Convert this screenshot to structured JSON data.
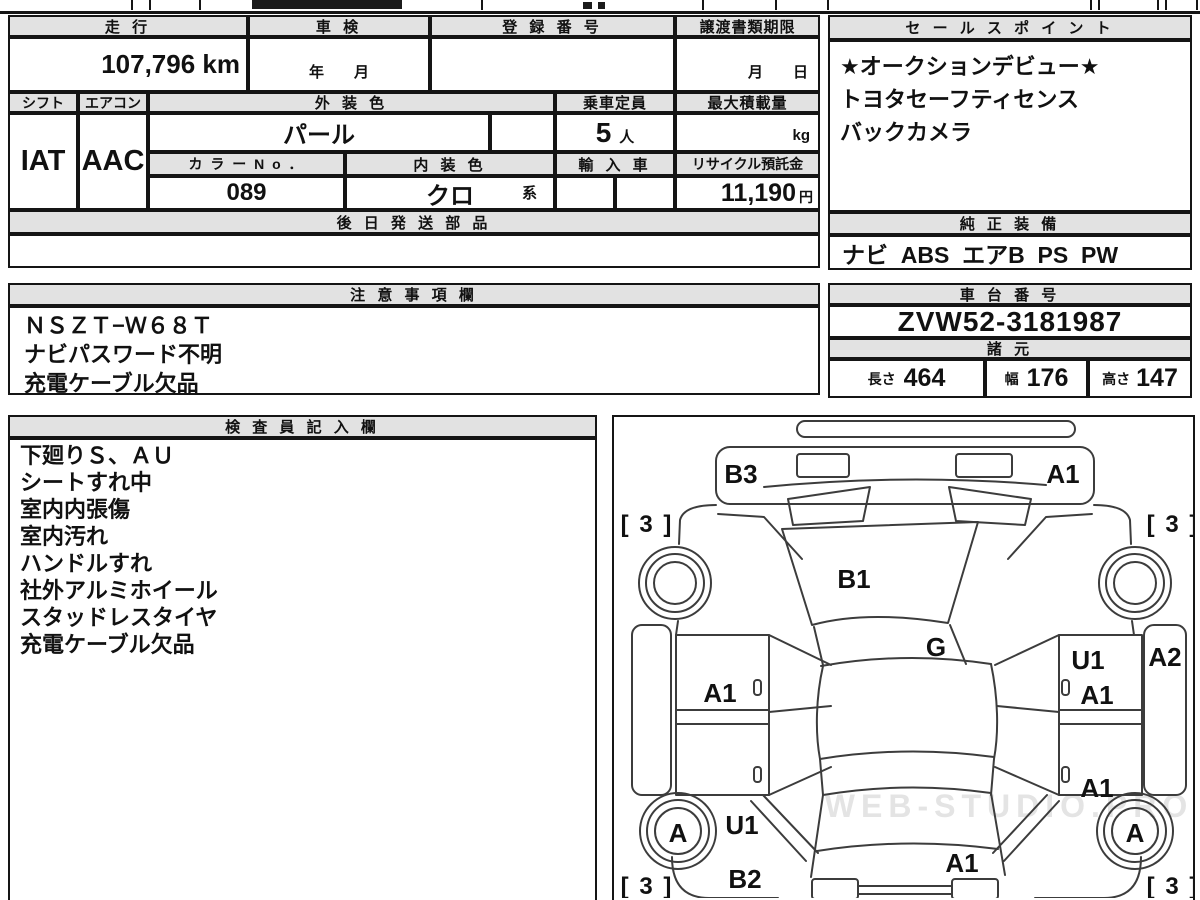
{
  "table": {
    "headers": {
      "mileage": "走 行",
      "shaken": "車 検",
      "registration_no": "登 録 番 号",
      "transfer_deadline": "譲渡書類期限",
      "shift": "シフト",
      "aircon": "エアコン",
      "exterior_color": "外 装 色",
      "capacity": "乗車定員",
      "max_load": "最大積載量",
      "color_no": "カ ラ ー N o ．",
      "interior_color": "内 装 色",
      "import_car": "輸 入 車",
      "recycle_deposit": "リサイクル預託金",
      "later_shipped_parts": "後 日 発 送 部 品"
    },
    "values": {
      "mileage": "107,796 km",
      "shaken_date": "年　　月",
      "registration_no": "",
      "transfer_deadline": "月　　日",
      "shift": "IAT",
      "aircon": "AAC",
      "exterior_color": "パール",
      "capacity_value": "5",
      "capacity_unit": "人",
      "max_load_unit": "kg",
      "color_no": "089",
      "interior_color": "クロ",
      "interior_color_suffix": "系",
      "recycle_deposit": "11,190",
      "recycle_deposit_unit": "円"
    }
  },
  "sales_point": {
    "title": "セ ー ル ス ポ イ ン ト",
    "line1": "★オークションデビュー★",
    "line2": "トヨタセーフティセンス",
    "line3": "バックカメラ"
  },
  "equipment": {
    "title": "純 正 装 備",
    "value": "ナビ  ABS  エアB  PS  PW"
  },
  "notes": {
    "title": "注 意 事 項 欄",
    "line1": "ＮＳＺＴ−Ｗ６８Ｔ",
    "line2": "ナビパスワード不明",
    "line3": "充電ケーブル欠品"
  },
  "chassis": {
    "title": "車 台 番 号",
    "value": "ZVW52-3181987"
  },
  "specs": {
    "title": "諸 元",
    "length_label": "長さ",
    "length_value": "464",
    "width_label": "幅",
    "width_value": "176",
    "height_label": "高さ",
    "height_value": "147"
  },
  "inspector": {
    "title": "検 査 員 記 入 欄",
    "line1": "下廻りＳ、ＡＵ",
    "line2": "シートすれ中",
    "line3": "室内内張傷",
    "line4": "室内汚れ",
    "line5": "ハンドルすれ",
    "line6": "社外アルミホイール",
    "line7": "スタッドレスタイヤ",
    "line8": "充電ケーブル欠品"
  },
  "diagram": {
    "watermark": "WEB-STUDIO.PRO",
    "labels": {
      "front_bumper_left": "B3",
      "front_bumper_right": "A1",
      "front_left_tire": "[ 3 ]",
      "front_right_tire": "[ 3 ]",
      "hood": "B1",
      "glass": "G",
      "right_front_door_u": "U1",
      "right_rocker": "A2",
      "right_front_door_a": "A1",
      "left_front_door": "A1",
      "right_rear_door": "A1",
      "left_rear_wheel": "A",
      "left_rear_quarter": "U1",
      "right_rear_wheel": "A",
      "left_rear_bumper": "B2",
      "tailgate": "A1",
      "rear_left_tire": "[ 3 ]",
      "rear_right_tire": "[ 3 ]"
    }
  }
}
